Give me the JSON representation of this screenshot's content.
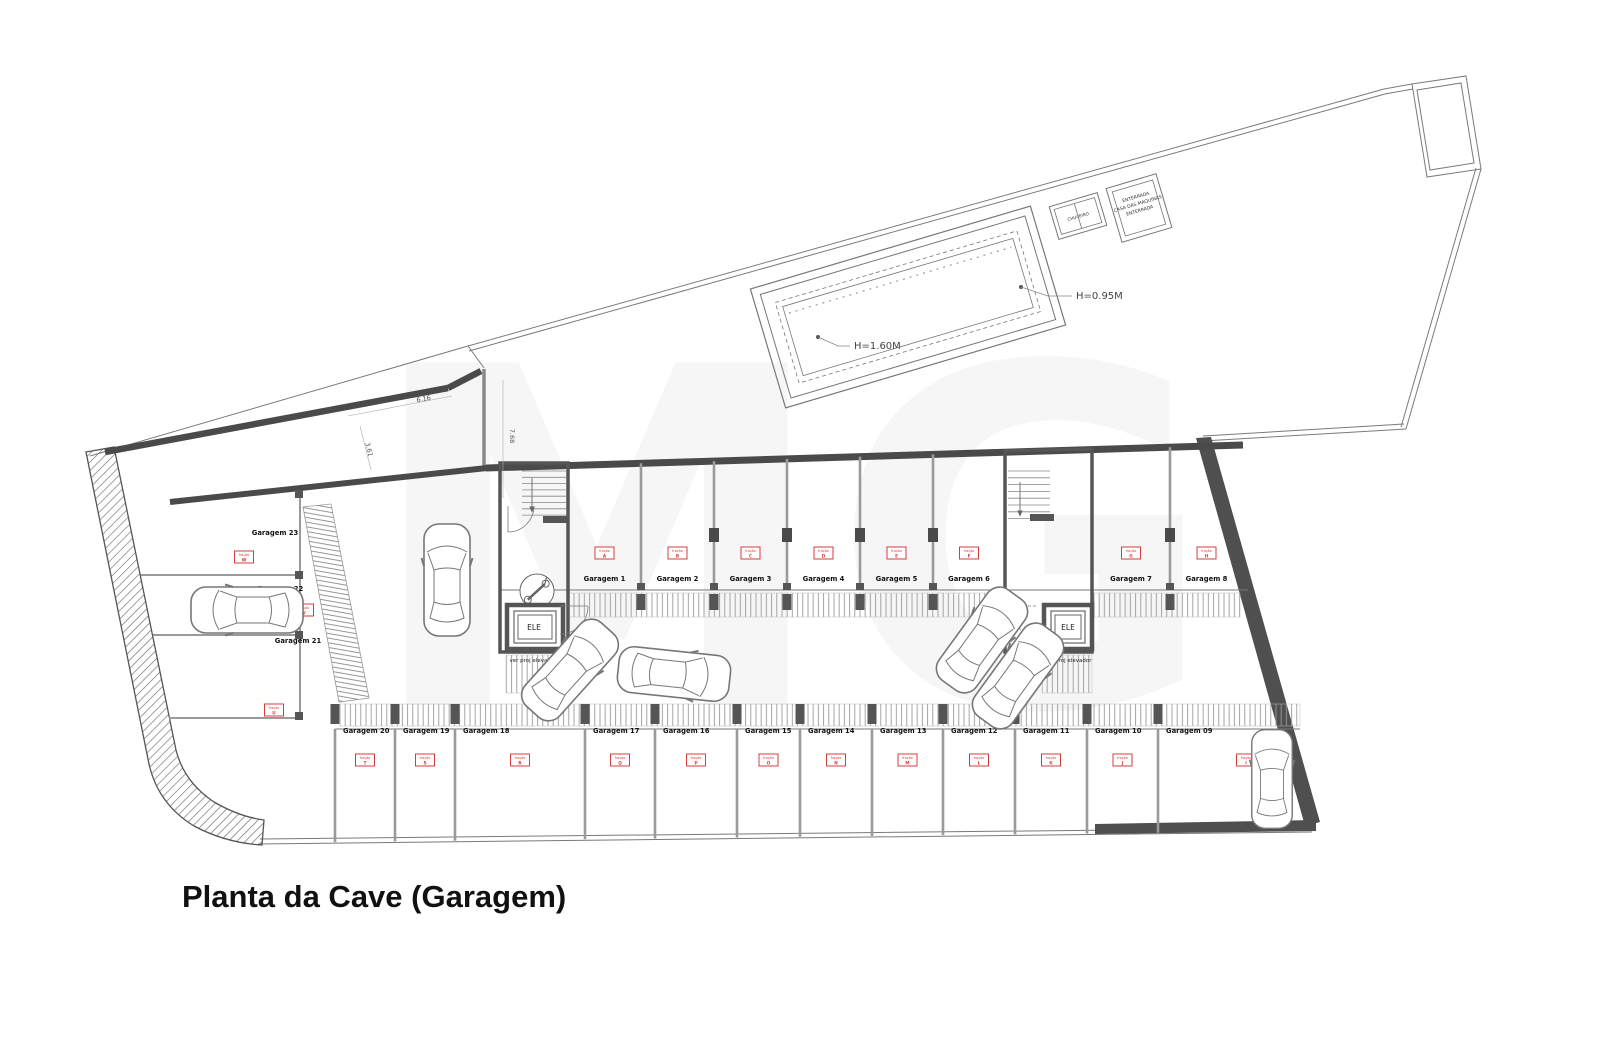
{
  "title": "Planta da Cave (Garagem)",
  "watermark": "MG",
  "pool": {
    "shallow": "H=0.95M",
    "deep": "H=1.60M"
  },
  "rooms": {
    "machine_room": {
      "line1": "ENTERRADA",
      "line2": "CASA DAS MAQUINAS",
      "line3": "ENTERRADA"
    },
    "shower": "CHUVEIRO"
  },
  "elevator": {
    "label": "ELE",
    "note": "ver proj elevador"
  },
  "dimensions": {
    "a": "6.16",
    "b": "7.68",
    "c": "3.61"
  },
  "fraction_word": "fração",
  "garages": [
    {
      "label": "Garagem 1",
      "letter": "A"
    },
    {
      "label": "Garagem 2",
      "letter": "B"
    },
    {
      "label": "Garagem 3",
      "letter": "C"
    },
    {
      "label": "Garagem 4",
      "letter": "D"
    },
    {
      "label": "Garagem 5",
      "letter": "E"
    },
    {
      "label": "Garagem 6",
      "letter": "F"
    },
    {
      "label": "Garagem 7",
      "letter": "G"
    },
    {
      "label": "Garagem 8",
      "letter": "H"
    },
    {
      "label": "Garagem 09",
      "letter": "I"
    },
    {
      "label": "Garagem 10",
      "letter": "J"
    },
    {
      "label": "Garagem 11",
      "letter": "K"
    },
    {
      "label": "Garagem 12",
      "letter": "L"
    },
    {
      "label": "Garagem 13",
      "letter": "M"
    },
    {
      "label": "Garagem 14",
      "letter": "N"
    },
    {
      "label": "Garagem 15",
      "letter": "O"
    },
    {
      "label": "Garagem 16",
      "letter": "P"
    },
    {
      "label": "Garagem 17",
      "letter": "Q"
    },
    {
      "label": "Garagem 18",
      "letter": "R"
    },
    {
      "label": "Garagem 19",
      "letter": "S"
    },
    {
      "label": "Garagem 20",
      "letter": "T"
    },
    {
      "label": "Garagem 21",
      "letter": "U"
    },
    {
      "label": "Garagem 22",
      "letter": "V"
    },
    {
      "label": "Garagem 23",
      "letter": "W"
    }
  ]
}
